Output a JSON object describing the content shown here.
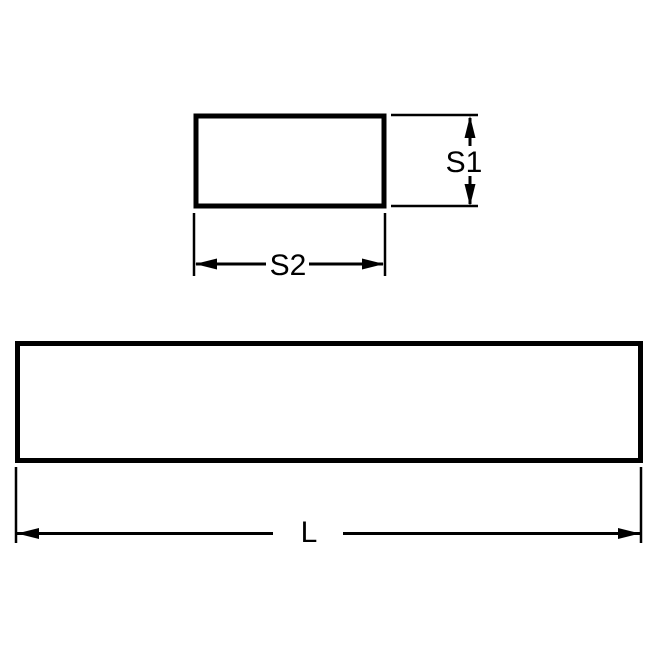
{
  "diagram": {
    "colors": {
      "line": "#000000",
      "background": "#ffffff"
    },
    "labels": {
      "s1": "S1",
      "s2": "S2",
      "l": "L"
    }
  }
}
